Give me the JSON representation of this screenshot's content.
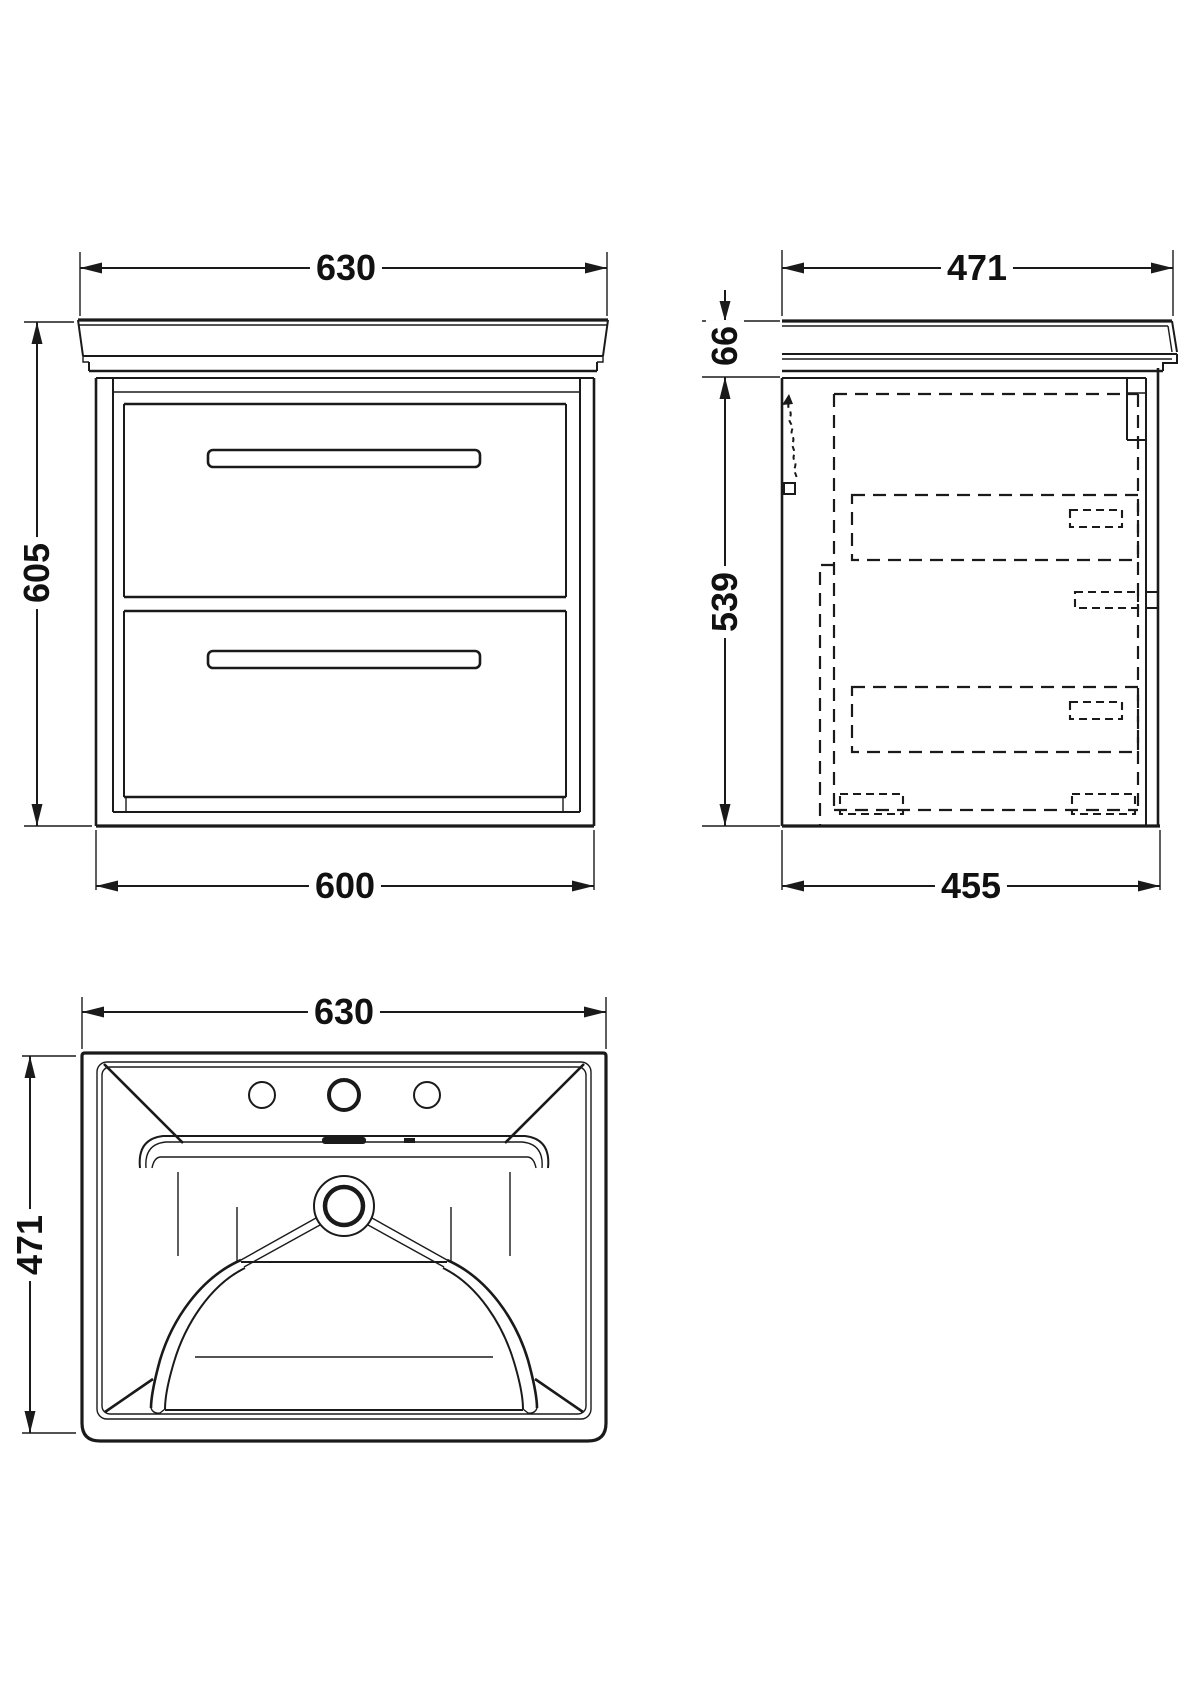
{
  "drawing": {
    "front_view": {
      "width_top": "630",
      "height": "605",
      "width_bottom": "600"
    },
    "side_view": {
      "depth_top": "471",
      "counter_height": "66",
      "cabinet_height": "539",
      "depth_bottom": "455"
    },
    "plan_view": {
      "width": "630",
      "depth": "471"
    }
  },
  "colors": {
    "line": "#1a1a1a",
    "background": "#ffffff"
  }
}
